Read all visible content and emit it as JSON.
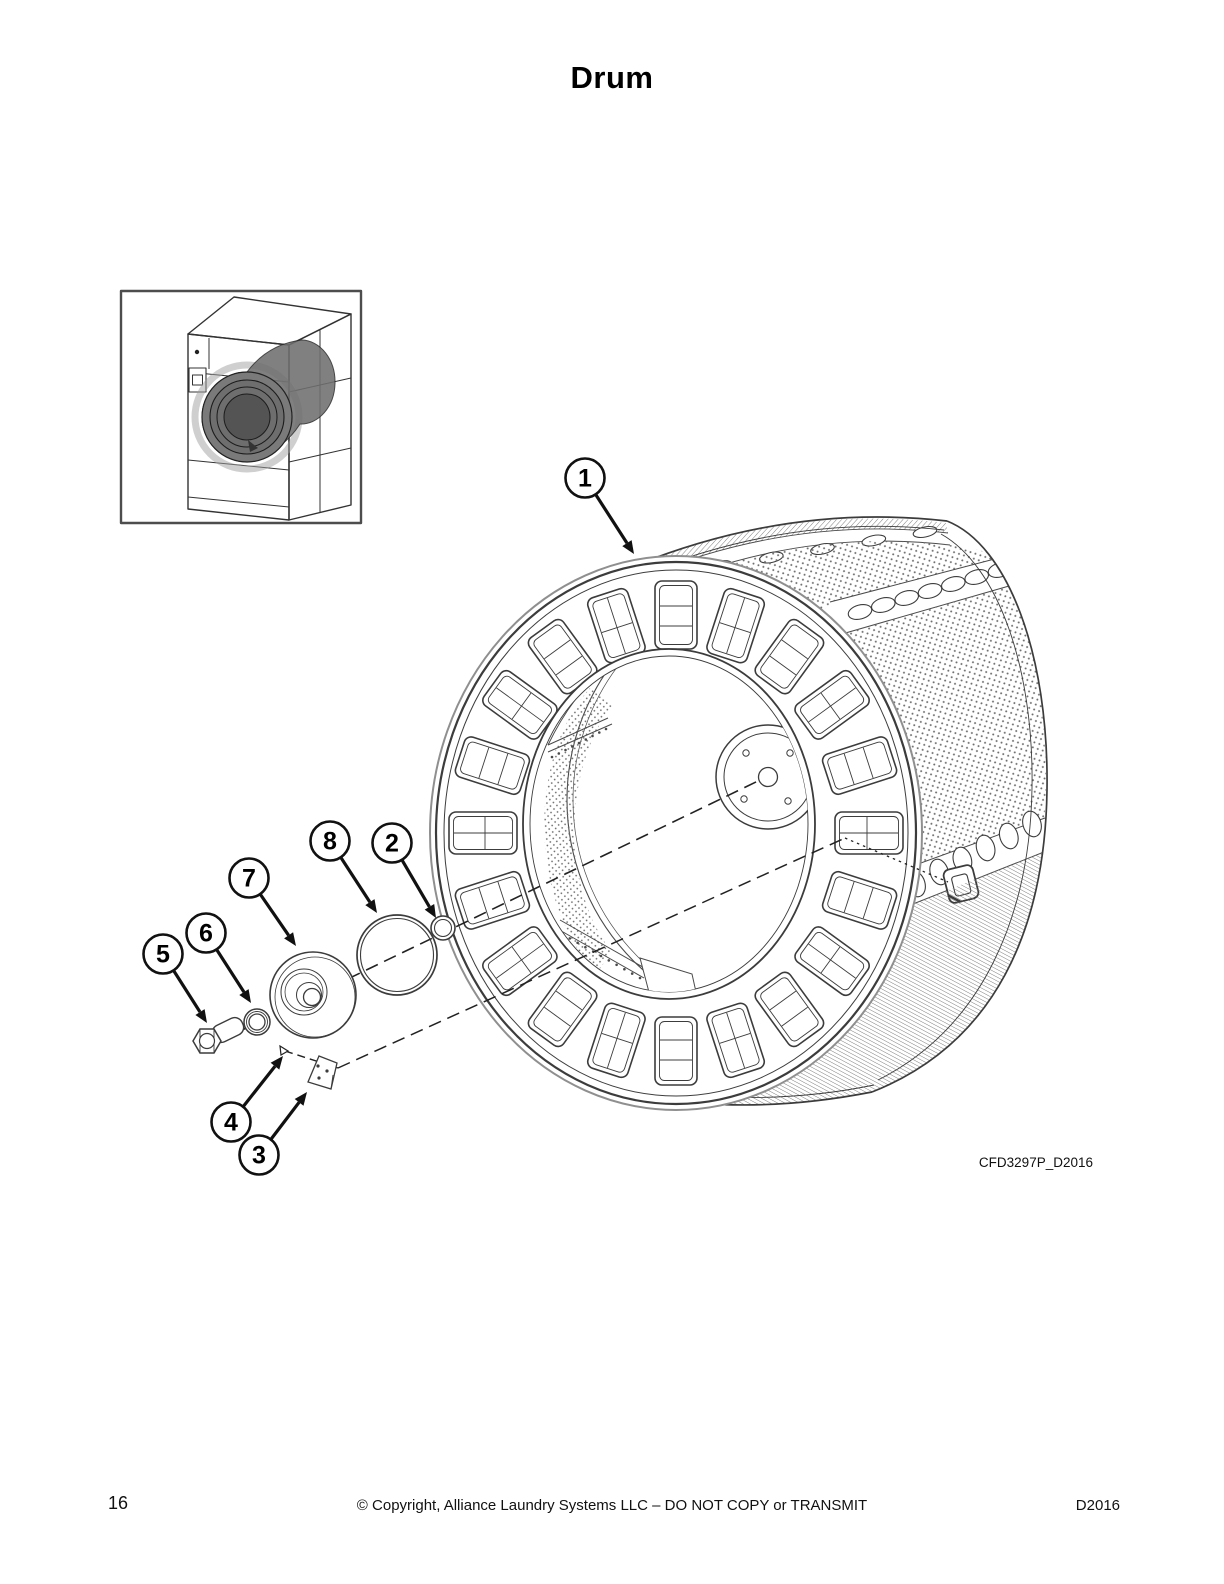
{
  "page": {
    "title": "Drum"
  },
  "figure": {
    "code": "CFD3297P_D2016",
    "callouts": [
      {
        "label": "1",
        "cx": 585,
        "cy": 478,
        "tx": 634,
        "ty": 554
      },
      {
        "label": "2",
        "cx": 392,
        "cy": 843,
        "tx": 436,
        "ty": 918
      },
      {
        "label": "3",
        "cx": 259,
        "cy": 1155,
        "tx": 307,
        "ty": 1092
      },
      {
        "label": "4",
        "cx": 231,
        "cy": 1122,
        "tx": 283,
        "ty": 1056
      },
      {
        "label": "5",
        "cx": 163,
        "cy": 954,
        "tx": 207,
        "ty": 1023
      },
      {
        "label": "6",
        "cx": 206,
        "cy": 933,
        "tx": 251,
        "ty": 1003
      },
      {
        "label": "7",
        "cx": 249,
        "cy": 878,
        "tx": 296,
        "ty": 946
      },
      {
        "label": "8",
        "cx": 330,
        "cy": 841,
        "tx": 377,
        "ty": 913
      }
    ]
  },
  "footer": {
    "page_number": "16",
    "copyright": "© Copyright, Alliance Laundry Systems LLC – DO NOT COPY or TRANSMIT",
    "doc_code": "D2016"
  }
}
